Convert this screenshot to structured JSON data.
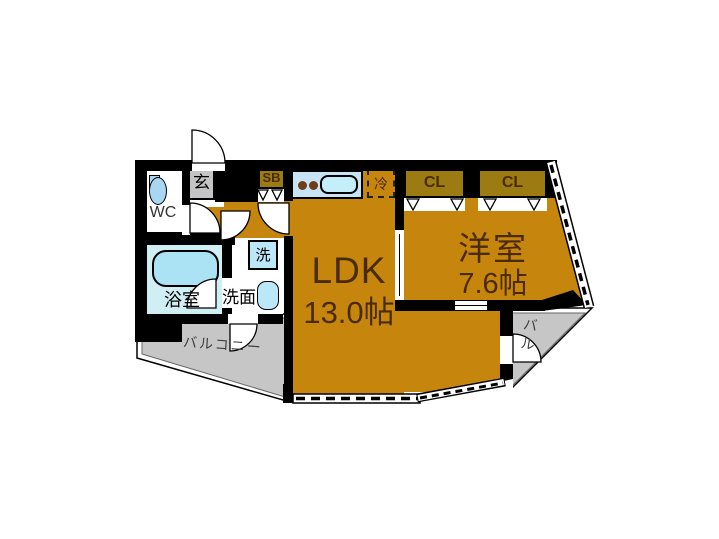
{
  "floorplan": {
    "rooms": {
      "ldk": {
        "label": "LDK",
        "size": "13.0帖"
      },
      "western_room": {
        "label": "洋室",
        "size": "7.6帖"
      },
      "bathroom": {
        "label": "浴室"
      },
      "washroom": {
        "label": "洗面"
      },
      "toilet": {
        "label": "WC"
      },
      "entrance": {
        "label": "玄"
      },
      "shoebox": {
        "label": "SB"
      },
      "refrigerator_space": {
        "label": "冷"
      },
      "washer_space": {
        "label": "洗"
      },
      "closet_left": {
        "label": "CL"
      },
      "closet_right": {
        "label": "CL"
      },
      "balcony": {
        "label": "バルコニー"
      },
      "balcony_corner": {
        "label": "バル"
      }
    },
    "colors": {
      "floor_orange": "#C6860E",
      "closet_brown": "#9C7C12",
      "fixture_blue": "#BCE7F8",
      "counter_blue": "#C7E3F4",
      "bathroom_floor": "#CFEFF4",
      "balcony_gray": "#C6C6C6",
      "entrance_gray": "#C4C4C4",
      "wall_black": "#000000",
      "label_dark_brown": "#4A2B00"
    }
  }
}
